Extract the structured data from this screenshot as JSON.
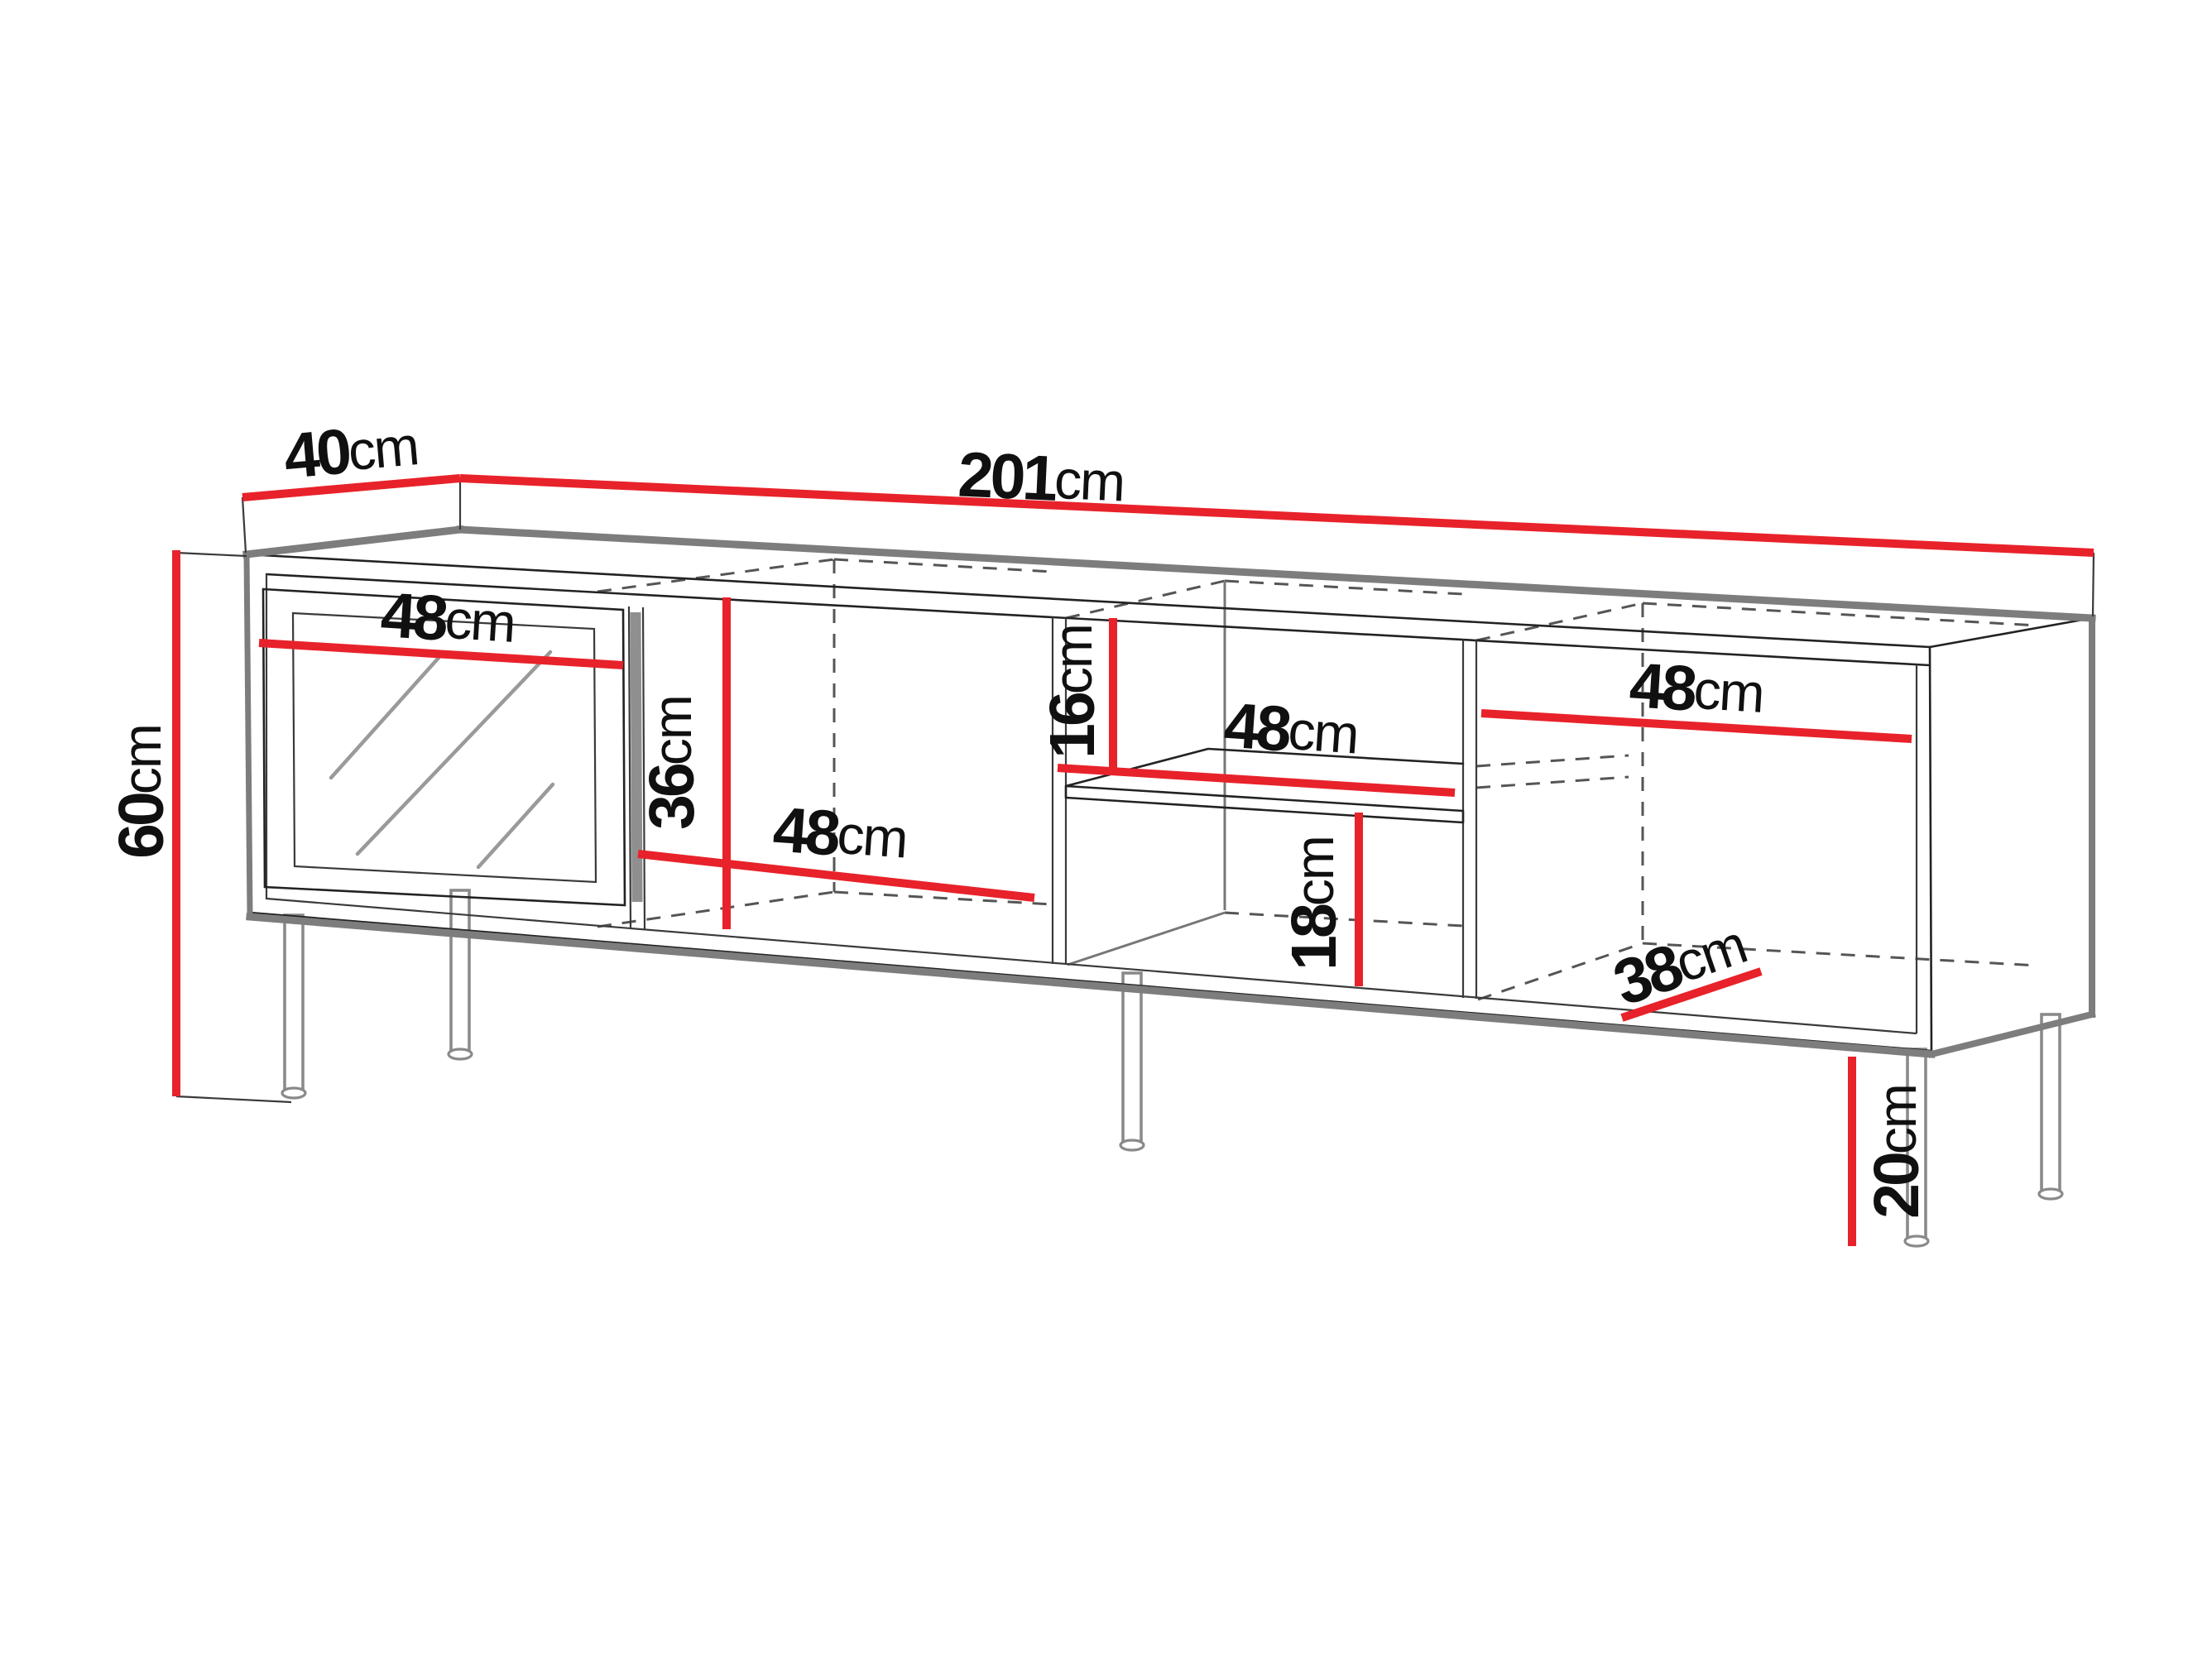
{
  "diagram": {
    "type": "furniture-dimension-drawing",
    "subject": "TV stand with glass door, open compartments, middle shelf and metal legs",
    "unit": "cm",
    "colors": {
      "dimension_line": "#e8222a",
      "outline": "#222222",
      "shadow_edge": "#7d7d7d",
      "hidden_edge_dashed": "#555555",
      "background": "#ffffff"
    },
    "dimensions": {
      "depth": {
        "value": "40",
        "unit": "cm"
      },
      "width": {
        "value": "201",
        "unit": "cm"
      },
      "height": {
        "value": "60",
        "unit": "cm"
      },
      "door_width": {
        "value": "48",
        "unit": "cm"
      },
      "interior_height": {
        "value": "36",
        "unit": "cm"
      },
      "middle_compartment_width": {
        "value": "48",
        "unit": "cm"
      },
      "above_shelf_height": {
        "value": "16",
        "unit": "cm"
      },
      "shelf_width": {
        "value": "48",
        "unit": "cm"
      },
      "below_shelf_height": {
        "value": "18",
        "unit": "cm"
      },
      "right_compartment_width": {
        "value": "48",
        "unit": "cm"
      },
      "interior_depth": {
        "value": "38",
        "unit": "cm"
      },
      "leg_height": {
        "value": "20",
        "unit": "cm"
      }
    }
  }
}
